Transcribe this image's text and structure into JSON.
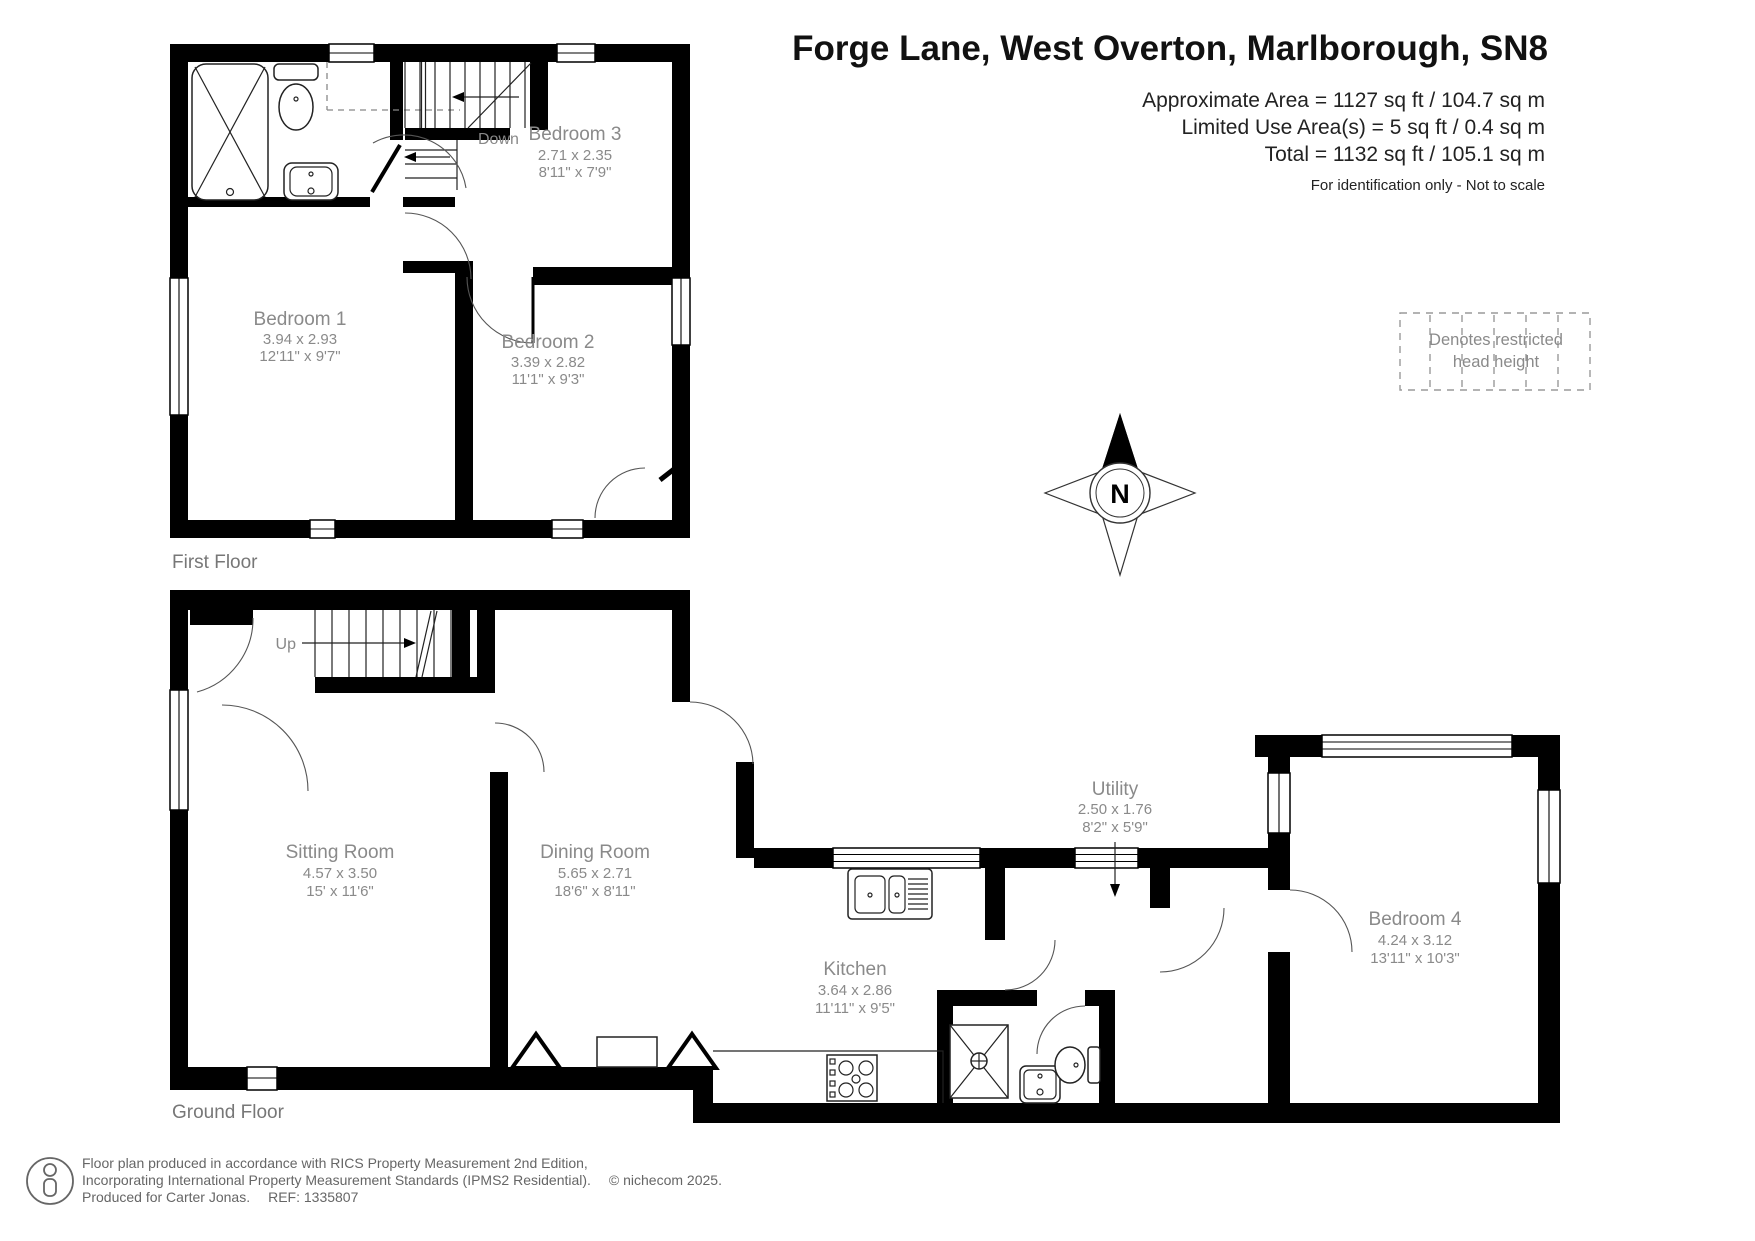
{
  "header": {
    "title": "Forge Lane, West Overton, Marlborough, SN8",
    "approx_area": "Approximate Area = 1127 sq ft / 104.7 sq m",
    "limited_area": "Limited Use Area(s) = 5 sq ft / 0.4 sq m",
    "total_area": "Total = 1132 sq ft / 105.1 sq m",
    "disclaimer": "For identification only - Not to scale"
  },
  "legend": {
    "restricted_line1": "Denotes restricted",
    "restricted_line2": "head height",
    "compass_north": "N"
  },
  "floors": {
    "first": {
      "label": "First Floor"
    },
    "ground": {
      "label": "Ground Floor"
    }
  },
  "rooms": {
    "bedroom1": {
      "name": "Bedroom 1",
      "metric": "3.94 x 2.93",
      "imperial": "12'11\" x 9'7\""
    },
    "bedroom2": {
      "name": "Bedroom 2",
      "metric": "3.39 x 2.82",
      "imperial": "11'1\" x 9'3\""
    },
    "bedroom3": {
      "name": "Bedroom 3",
      "metric": "2.71 x 2.35",
      "imperial": "8'11\" x 7'9\""
    },
    "bedroom4": {
      "name": "Bedroom 4",
      "metric": "4.24 x 3.12",
      "imperial": "13'11\" x 10'3\""
    },
    "sitting_room": {
      "name": "Sitting Room",
      "metric": "4.57 x 3.50",
      "imperial": "15' x 11'6\""
    },
    "dining_room": {
      "name": "Dining Room",
      "metric": "5.65 x 2.71",
      "imperial": "18'6\" x 8'11\""
    },
    "kitchen": {
      "name": "Kitchen",
      "metric": "3.64 x 2.86",
      "imperial": "11'11\" x 9'5\""
    },
    "utility": {
      "name": "Utility",
      "metric": "2.50 x 1.76",
      "imperial": "8'2\" x 5'9\""
    }
  },
  "stairs": {
    "first_floor": "Down",
    "ground_floor": "Up"
  },
  "footer": {
    "line1": "Floor plan produced in accordance with RICS Property Measurement 2nd Edition,",
    "line2": "Incorporating International Property Measurement Standards (IPMS2 Residential).",
    "copyright": "© nichecom 2025.",
    "line3": "Produced for Carter Jonas.",
    "ref": "REF: 1335807"
  },
  "colors": {
    "wall": "#000000",
    "label_gray": "#8a8a8a",
    "title": "#111111"
  }
}
